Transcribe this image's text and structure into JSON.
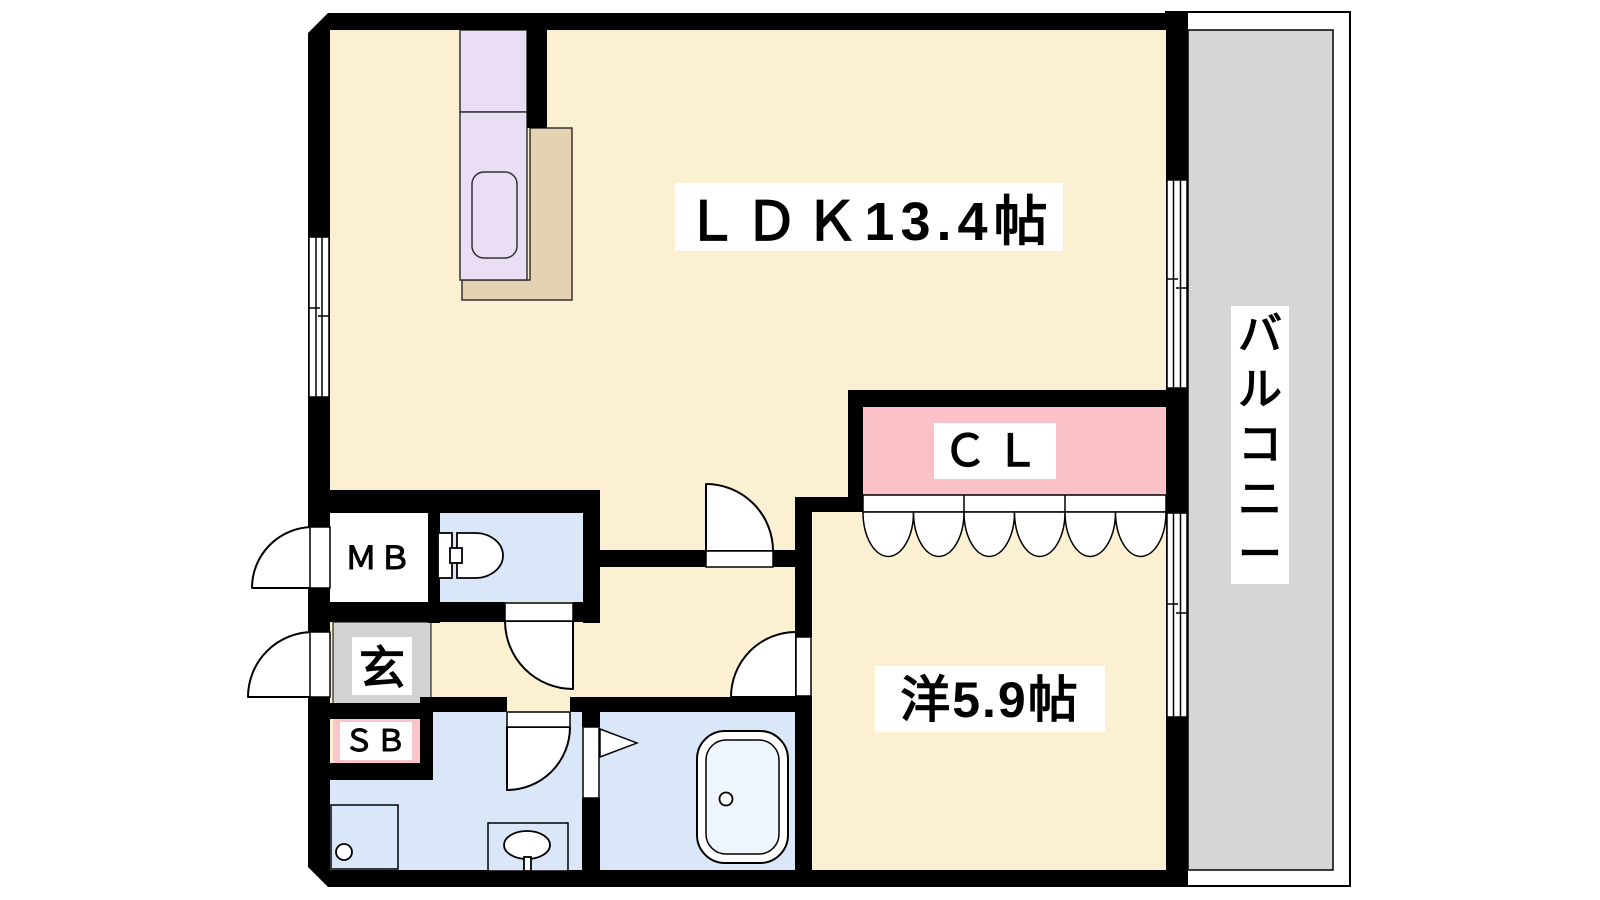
{
  "plan": {
    "title": "1LDK floor plan",
    "rooms": {
      "ldk": {
        "label": "ＬＤＫ13.4帖"
      },
      "western_room": {
        "label": "洋5.9帖"
      },
      "closet": {
        "label": "ＣＬ"
      },
      "balcony": {
        "label": "バルコニー",
        "label_chars": [
          "バ",
          "ル",
          "コ",
          "ニ",
          "ー"
        ]
      },
      "meter_box": {
        "label": "ＭＢ"
      },
      "entrance": {
        "label": "玄"
      },
      "shoe_box": {
        "label": "ＳＢ"
      }
    },
    "colors": {
      "floor": "#FCF0D3",
      "wet_area": "#DAE7F8",
      "closet_pink": "#FBC1C8",
      "shoebox_pink": "#FBC6CB",
      "entrance_gray": "#D2D2D2",
      "balcony_gray": "#D6D6D6",
      "kitchen_lavender": "#E9DEF4",
      "kitchen_counter_tan": "#E5D2B3",
      "tub_inner": "#EFF5FC",
      "wall": "#000000"
    }
  }
}
